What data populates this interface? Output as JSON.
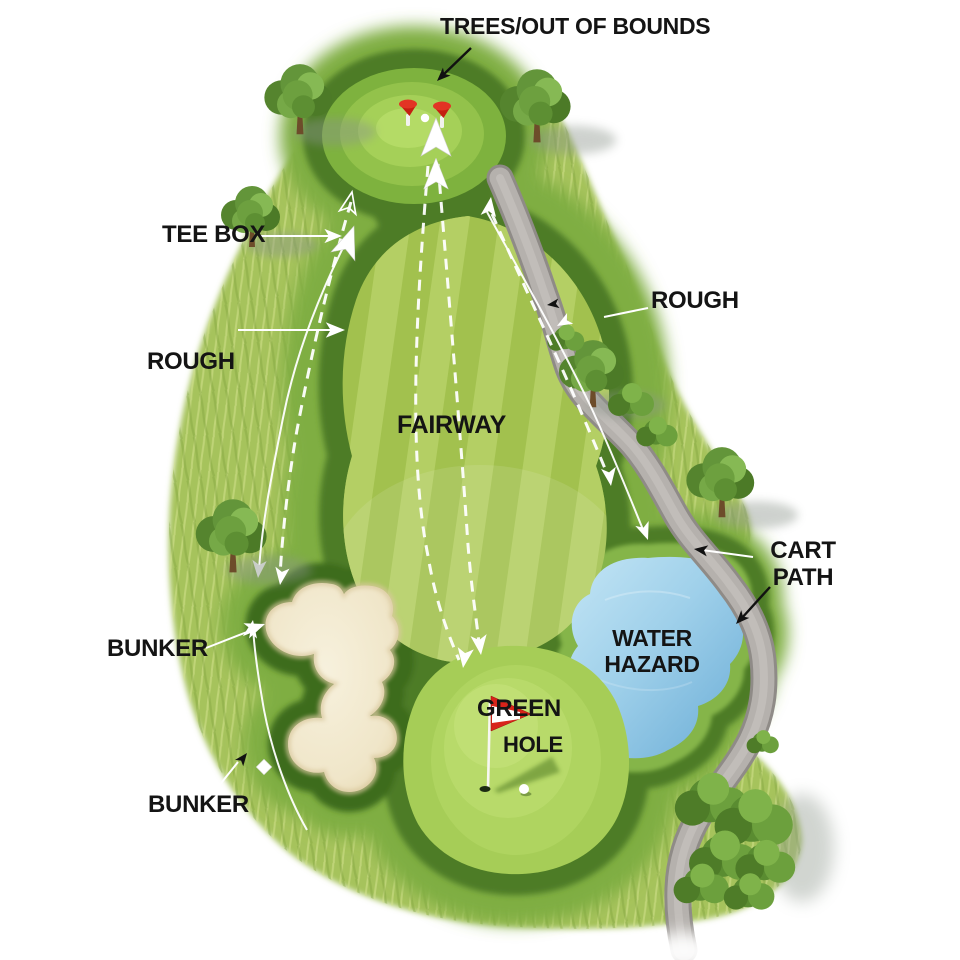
{
  "diagram": {
    "type": "golf-hole-overview",
    "labels": {
      "trees_oob": "TREES/OUT OF BOUNDS",
      "tee_box": "TEE BOX",
      "rough_left": "ROUGH",
      "rough_right": "ROUGH",
      "fairway": "FAIRWAY",
      "cart_path": [
        "CART",
        "PATH"
      ],
      "water_hazard": [
        "WATER",
        "HAZARD"
      ],
      "bunker_upper": "BUNKER",
      "bunker_lower": "BUNKER",
      "green": "GREEN",
      "hole": "HOLE"
    },
    "icons": {
      "tee_marker": "red-cone-tee-marker",
      "golf_ball": "white-ball",
      "flag": "red-white-pennant-flag",
      "hole_cup": "dark-ellipse",
      "tree": "green-canopy-tree",
      "bush": "green-shrub",
      "route_arrow": "white-arrowhead",
      "annotation_arrow": "black-arrowhead"
    },
    "colors": {
      "fairway": "#a2c14e",
      "fairway_stripe": "#b6d066",
      "rough_outer": "#a6c35c",
      "rough_mid": "#7fae43",
      "rough_dark": "#4d7b26",
      "green_surface": "#a6cd57",
      "sand": "#f2e9cf",
      "water": "#8fc4e4",
      "cart_path": "#b5b1ad",
      "flag_red": "#d8231a",
      "label_text": "#141414",
      "route_white": "#ffffff",
      "annotation_black": "#111111"
    }
  }
}
